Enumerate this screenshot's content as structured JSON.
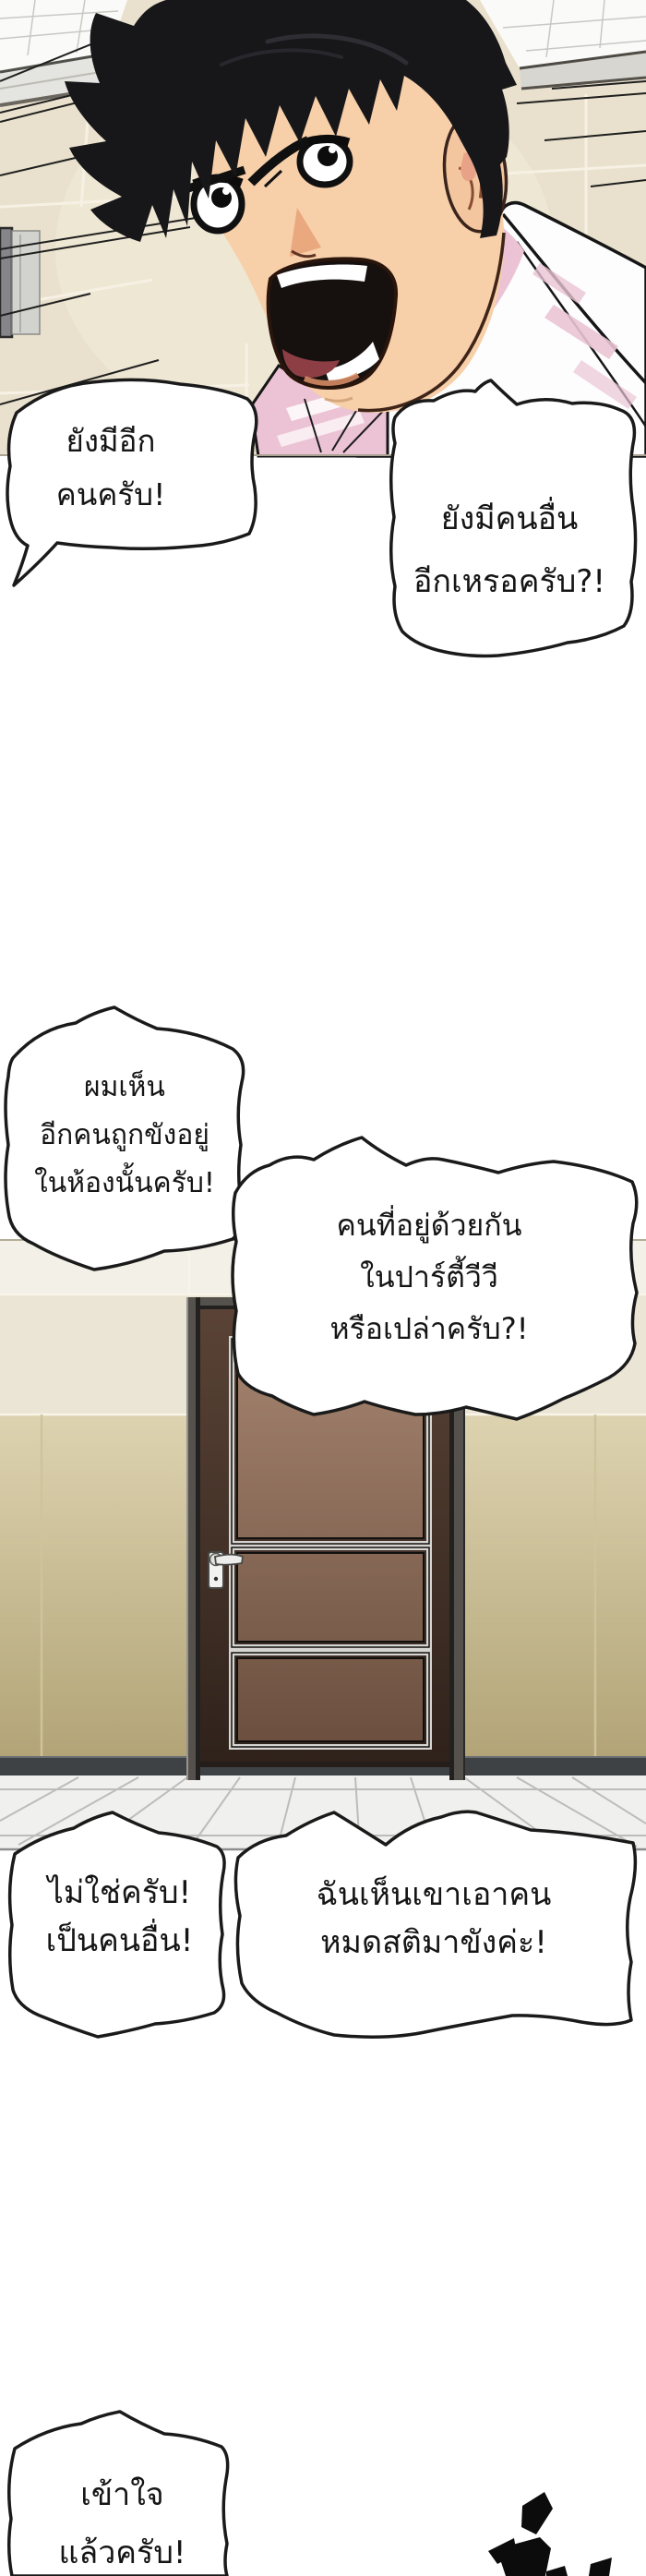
{
  "bubbles": [
    {
      "id": "bubble-1",
      "lines": [
        "ยังมีอีก",
        "คนครับ!"
      ]
    },
    {
      "id": "bubble-2",
      "lines": [
        "ยังมีคนอื่น",
        "อีกเหรอครับ?!"
      ]
    },
    {
      "id": "bubble-3",
      "lines": [
        "ผมเห็น",
        "อีกคนถูกขังอยู่",
        "ในห้องนั้นครับ!"
      ]
    },
    {
      "id": "bubble-4",
      "lines": [
        "คนที่อยู่ด้วยกัน",
        "ในปาร์ตี้วีวี",
        "หรือเปล่าครับ?!"
      ]
    },
    {
      "id": "bubble-5",
      "lines": [
        "ไม่ใช่ครับ!",
        "เป็นคนอื่น!"
      ]
    },
    {
      "id": "bubble-6",
      "lines": [
        "ฉันเห็นเขาเอาคน",
        "หมดสติมาขังค่ะ!"
      ]
    },
    {
      "id": "bubble-7",
      "lines": [
        "เข้าใจ",
        "แล้วครับ!"
      ]
    }
  ],
  "colors": {
    "bubble_fill": "#ffffff",
    "bubble_outline": "#1a1a1a",
    "text": "#151515",
    "wall_tile_beige": "#e9e1cd",
    "wall_tile_khaki": "#c9bc92",
    "door_frame_gray": "#55524d",
    "door_wood_dark": "#423027",
    "door_panel_brown": "#8a6a57",
    "floor_tile": "#f0f0ee",
    "hair_black": "#17171a",
    "skin": "#f7cfa9",
    "hoodie_white": "#fdfdfd",
    "hoodie_pink": "#ecc3d4",
    "mouth_interior": "#16100f",
    "tongue_red": "#8c3e44"
  }
}
